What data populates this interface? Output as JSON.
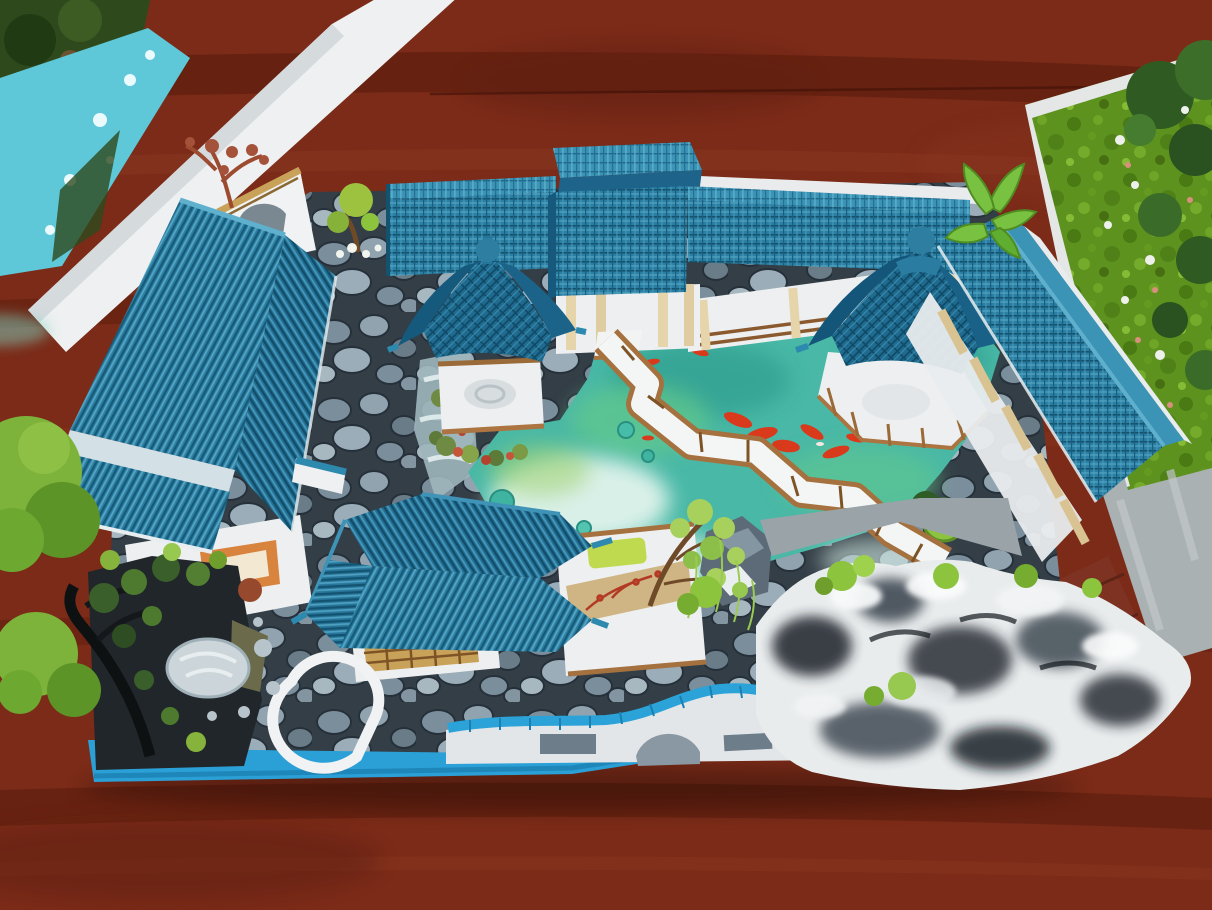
{
  "caption": "Top-down photograph of a miniature Chinese garden courtyard model with blue tiled roofs, koi pond, zigzag bridge, rockery and trees, placed on a red-brown wooden table between two neighboring landscape models",
  "palette": {
    "wood_base": "#7b2b18",
    "wood_dark": "#571b0c",
    "wood_light": "#97412a",
    "neighbor_white": "#eef0f1",
    "neighbor_water": "#5ec8d8",
    "foliage_dark": "#2e4a1d",
    "grass": "#5d921e",
    "tree_dark": "#335c24",
    "stone_white": "#eef0ec",
    "path_gray": "#aab1b3",
    "floor_red": "#7e3322",
    "base_blue": "#2aa0d6",
    "roof_main": "#26759a",
    "roof_dark": "#16597c",
    "roof_light": "#4298bb",
    "roof_ridge": "#5fb0cd",
    "wall_white": "#edeff0",
    "wall_shadow": "#c7cdd2",
    "post_cream": "#e6d5ab",
    "wood_trim": "#ab7440",
    "wood_trim_dark": "#7e5426",
    "pond_base": "#49b8a6",
    "pond_green": "#63c98c",
    "pond_white": "#e9f7f0",
    "pond_deep": "#2a9a8c",
    "lily_green": "#3fb4a1",
    "koi_red": "#d93a1c",
    "rock_light": "#e9eced",
    "rock_black": "#1c2329",
    "rock_mid": "#6b7a84",
    "moss_bright": "#8cc43e",
    "tree_bright": "#7db33b",
    "screen_tan": "#cfb584",
    "pad_green": "#c0da50",
    "disc_gray": "#ccd5d9",
    "gable_trim_gold": "#c9a25a",
    "dry_tree_red": "#9c4a30"
  },
  "objects": [
    "wooden-table",
    "left-neighbor-model",
    "right-neighbor-lawn-model",
    "main-model-base",
    "cobblestone-courtyard",
    "koi-pond",
    "zigzag-bridge",
    "left-hall-building",
    "north-corridor",
    "gate-tower",
    "hexagonal-gazebo",
    "water-pavilion",
    "east-gallery-building",
    "terrace-hall",
    "willow-tree",
    "south-pavilion",
    "hexagonal-doorway",
    "cloud-wall",
    "rockery",
    "black-tree-garden",
    "moon-stone-disc",
    "bonsai-trees",
    "plantain-plant"
  ]
}
